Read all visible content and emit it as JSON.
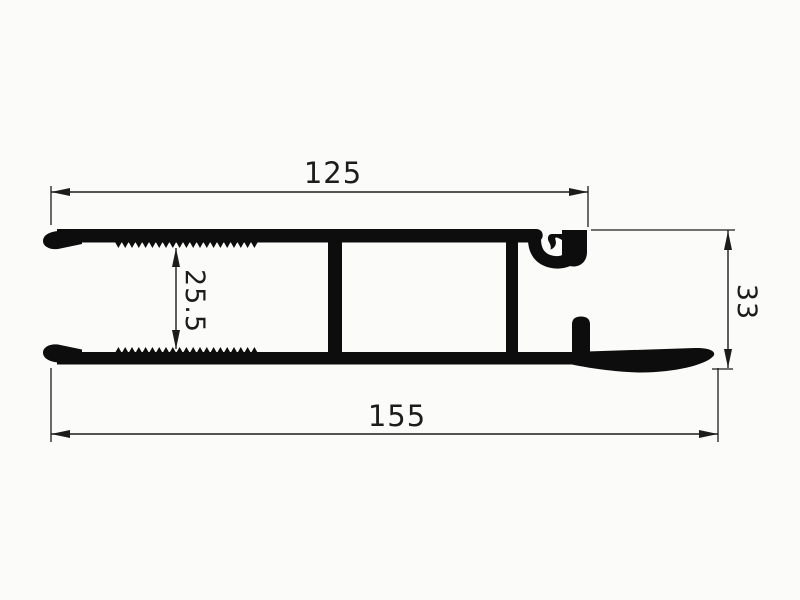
{
  "drawing": {
    "type": "technical-cross-section",
    "description": "Aluminium clamping profile cross-section with serrated flanges, two webs, gasket channel and winged base flange",
    "dimensions": {
      "top_width_mm": "125",
      "clamp_gap_mm": "25.5",
      "overall_height_mm": "33",
      "overall_width_mm": "155"
    },
    "serration": {
      "start_x": 115,
      "end_x": 258,
      "tooth_pitch": 6.8,
      "tooth_depth": 6
    },
    "colors": {
      "ink": "#0d0d0d",
      "dimension_line": "#1c1c1c",
      "background": "#fbfbfa"
    }
  }
}
